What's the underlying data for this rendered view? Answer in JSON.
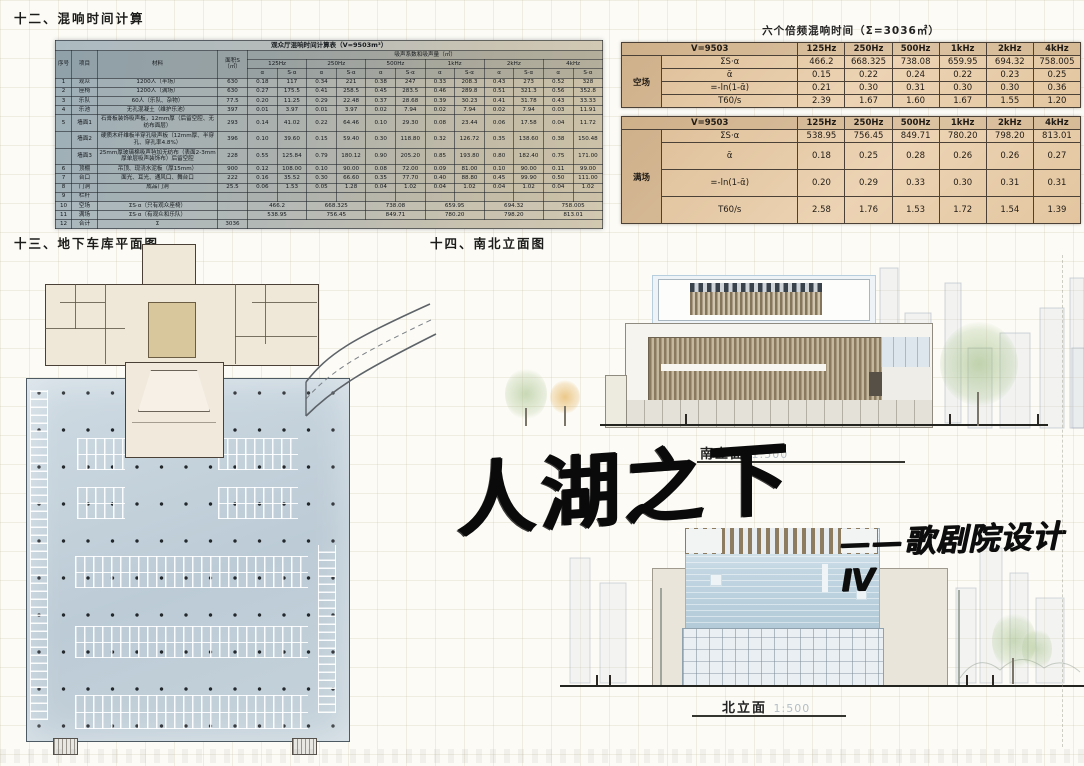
{
  "sections": {
    "s12": "十二、混响时间计算",
    "s13": "十三、地下车库平面图",
    "s14": "十四、南北立面图"
  },
  "title": {
    "main": "人湖之下",
    "sub": "——歌剧院设计Ⅳ"
  },
  "elevations": {
    "south": {
      "label": "南立面",
      "scale": "1:500"
    },
    "north": {
      "label": "北立面",
      "scale": "1:500"
    }
  },
  "freq_tables": {
    "title": "六个倍频混响时间（Σ=3036㎡）",
    "volume_label": "V=9503",
    "freqs": [
      "125Hz",
      "250Hz",
      "500Hz",
      "1kHz",
      "2kHz",
      "4kHz"
    ],
    "row_headers": [
      "ΣS·α",
      "ᾱ",
      "=-ln(1-ᾱ)",
      "T60/s"
    ],
    "tables": [
      {
        "condition": "空场",
        "rows": [
          [
            "466.2",
            "668.325",
            "738.08",
            "659.95",
            "694.32",
            "758.005"
          ],
          [
            "0.15",
            "0.22",
            "0.24",
            "0.22",
            "0.23",
            "0.25"
          ],
          [
            "0.21",
            "0.30",
            "0.31",
            "0.30",
            "0.30",
            "0.36"
          ],
          [
            "2.39",
            "1.67",
            "1.60",
            "1.67",
            "1.55",
            "1.20"
          ]
        ]
      },
      {
        "condition": "满场",
        "rows": [
          [
            "538.95",
            "756.45",
            "849.71",
            "780.20",
            "798.20",
            "813.01"
          ],
          [
            "0.18",
            "0.25",
            "0.28",
            "0.26",
            "0.26",
            "0.27"
          ],
          [
            "0.20",
            "0.29",
            "0.33",
            "0.30",
            "0.31",
            "0.31"
          ],
          [
            "2.58",
            "1.76",
            "1.53",
            "1.72",
            "1.54",
            "1.39"
          ]
        ]
      }
    ]
  },
  "big_table": {
    "title": "观众厅混响时间计算表（V=9503m³）",
    "headers": {
      "no": "序号",
      "item": "项目",
      "material": "材料",
      "area": "面积S（㎡）",
      "band": "吸声系数和吸声量（㎡）",
      "alpha": "α",
      "salpha": "S·α"
    },
    "freqs": [
      "125Hz",
      "250Hz",
      "500Hz",
      "1kHz",
      "2kHz",
      "4kHz"
    ],
    "rows": [
      {
        "no": "1",
        "item": "观众",
        "material": "1200人（半场）",
        "area": "630",
        "vals": [
          [
            "0.18",
            "117"
          ],
          [
            "0.34",
            "221"
          ],
          [
            "0.38",
            "247"
          ],
          [
            "0.33",
            "208.3"
          ],
          [
            "0.43",
            "273"
          ],
          [
            "0.52",
            "328"
          ]
        ]
      },
      {
        "no": "2",
        "item": "座椅",
        "material": "1200人（满场）",
        "area": "630",
        "vals": [
          [
            "0.27",
            "175.5"
          ],
          [
            "0.41",
            "258.5"
          ],
          [
            "0.45",
            "283.5"
          ],
          [
            "0.46",
            "289.8"
          ],
          [
            "0.51",
            "321.3"
          ],
          [
            "0.56",
            "352.8"
          ]
        ]
      },
      {
        "no": "3",
        "item": "乐队",
        "material": "60人（乐队、杂物）",
        "area": "77.5",
        "vals": [
          [
            "0.20",
            "11.25"
          ],
          [
            "0.29",
            "22.48"
          ],
          [
            "0.37",
            "28.68"
          ],
          [
            "0.39",
            "30.23"
          ],
          [
            "0.41",
            "31.78"
          ],
          [
            "0.43",
            "33.33"
          ]
        ]
      },
      {
        "no": "4",
        "item": "乐池",
        "material": "无孔混凝土（维护乐池）",
        "area": "397",
        "vals": [
          [
            "0.01",
            "3.97"
          ],
          [
            "0.01",
            "3.97"
          ],
          [
            "0.02",
            "7.94"
          ],
          [
            "0.02",
            "7.94"
          ],
          [
            "0.02",
            "7.94"
          ],
          [
            "0.03",
            "11.91"
          ]
        ]
      },
      {
        "no": "5",
        "item": "墙面1",
        "material": "石膏板装饰吸声板，12mm厚（后留空腔、无纺布面层）",
        "area": "293",
        "vals": [
          [
            "0.14",
            "41.02"
          ],
          [
            "0.22",
            "64.46"
          ],
          [
            "0.10",
            "29.30"
          ],
          [
            "0.08",
            "23.44"
          ],
          [
            "0.06",
            "17.58"
          ],
          [
            "0.04",
            "11.72"
          ]
        ]
      },
      {
        "no": "",
        "item": "墙面2",
        "material": "硬质木纤维板半穿孔吸声板（12mm厚、半穿孔、穿孔率4.8%）",
        "area": "396",
        "vals": [
          [
            "0.10",
            "39.60"
          ],
          [
            "0.15",
            "59.40"
          ],
          [
            "0.30",
            "118.80"
          ],
          [
            "0.32",
            "126.72"
          ],
          [
            "0.35",
            "138.60"
          ],
          [
            "0.38",
            "150.48"
          ]
        ]
      },
      {
        "no": "",
        "item": "墙面3",
        "material": "25mm厚玻璃棉吸声毡加无纺布（表面2-3mm厚单层吸声装饰布）后留空腔",
        "area": "228",
        "vals": [
          [
            "0.55",
            "125.84"
          ],
          [
            "0.79",
            "180.12"
          ],
          [
            "0.90",
            "205.20"
          ],
          [
            "0.85",
            "193.80"
          ],
          [
            "0.80",
            "182.40"
          ],
          [
            "0.75",
            "171.00"
          ]
        ]
      },
      {
        "no": "6",
        "item": "顶棚",
        "material": "吊顶、现浇水泥板（厚15mm）",
        "area": "900",
        "vals": [
          [
            "0.12",
            "108.00"
          ],
          [
            "0.10",
            "90.00"
          ],
          [
            "0.08",
            "72.00"
          ],
          [
            "0.09",
            "81.00"
          ],
          [
            "0.10",
            "90.00"
          ],
          [
            "0.11",
            "99.00"
          ]
        ]
      },
      {
        "no": "7",
        "item": "台口",
        "material": "面光、耳光、通风口、舞台口",
        "area": "222",
        "vals": [
          [
            "0.16",
            "35.52"
          ],
          [
            "0.30",
            "66.60"
          ],
          [
            "0.35",
            "77.70"
          ],
          [
            "0.40",
            "88.80"
          ],
          [
            "0.45",
            "99.90"
          ],
          [
            "0.50",
            "111.00"
          ]
        ]
      },
      {
        "no": "8",
        "item": "门洞",
        "material": "成品门洞",
        "area": "25.5",
        "vals": [
          [
            "0.06",
            "1.53"
          ],
          [
            "0.05",
            "1.28"
          ],
          [
            "0.04",
            "1.02"
          ],
          [
            "0.04",
            "1.02"
          ],
          [
            "0.04",
            "1.02"
          ],
          [
            "0.04",
            "1.02"
          ]
        ]
      },
      {
        "no": "9",
        "item": "栏杆",
        "material": "",
        "area": "",
        "vals": [
          [
            "",
            ""
          ],
          [
            "",
            ""
          ],
          [
            "",
            ""
          ],
          [
            "",
            ""
          ],
          [
            "",
            ""
          ],
          [
            "",
            ""
          ]
        ]
      }
    ],
    "summary_rows": [
      {
        "no": "10",
        "item": "空场",
        "material": "ΣS·α（只有观众座椅）",
        "vals": [
          "466.2",
          "668.325",
          "738.08",
          "659.95",
          "694.32",
          "758.005"
        ]
      },
      {
        "no": "11",
        "item": "满场",
        "material": "ΣS·α（有观众和乐队）",
        "vals": [
          "538.95",
          "756.45",
          "849.71",
          "780.20",
          "798.20",
          "813.01"
        ]
      }
    ],
    "total_row": {
      "no": "12",
      "item": "合计",
      "material": "Σ",
      "area": "3036"
    }
  },
  "colors": {
    "table_orange": "#e6c9a4",
    "table_slate": "#9fb0b8",
    "plan_beige": "#efe7d7",
    "plan_blue": "#c7d5de",
    "louver_brown": "#8a7a5e",
    "glass_blue": "#c2d6e2",
    "ink": "#0a0a0a"
  }
}
